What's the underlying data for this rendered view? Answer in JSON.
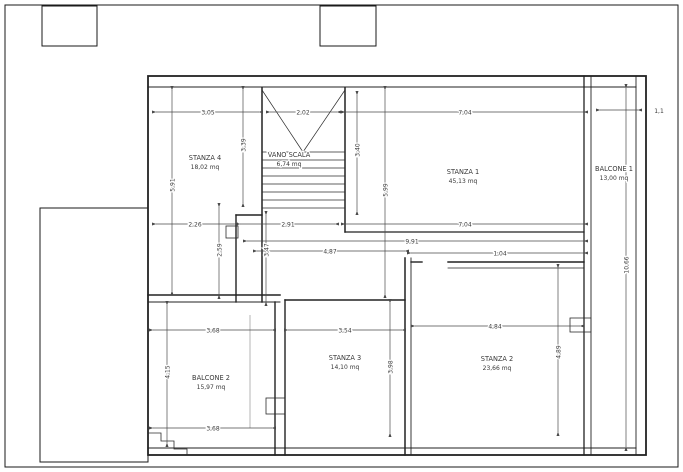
{
  "plan": {
    "rooms": {
      "stanza1": {
        "name": "STANZA 1",
        "area": "45,13 mq"
      },
      "stanza2": {
        "name": "STANZA 2",
        "area": "23,66 mq"
      },
      "stanza3": {
        "name": "STANZA 3",
        "area": "14,10 mq"
      },
      "stanza4": {
        "name": "STANZA 4",
        "area": "18,02 mq"
      },
      "vano_scala": {
        "name": "VANO SCALA",
        "area": "6,74 mq"
      },
      "balcone1": {
        "name": "BALCONE 1",
        "area": "13,00 mq"
      },
      "balcone2": {
        "name": "BALCONE 2",
        "area": "15,97 mq"
      }
    },
    "dimensions": {
      "h_top_stanza4": "3,05",
      "h_top_scala": "2,02",
      "h_top_stanza1": "7,04",
      "h_top_balcone1": "1,1",
      "h_mid_left": "2,26",
      "h_mid_corridoio": "2,91",
      "h_mid_stanza1": "7,04",
      "h_mid_long": "9,91",
      "h_mid_hall": "4,87",
      "h_mid_door": "1,04",
      "h_bot_balcone2": "3,68",
      "h_bot_stanza3": "3,54",
      "h_bot_stanza2": "4,84",
      "h_bot_balcone2_lower": "3,68",
      "v_left_stanza4": "5,91",
      "v_stanza4_inner": "3,39",
      "v_scala_right": "3,40",
      "v_stanza1_left": "5,99",
      "v_left_lower": "2,59",
      "v_corridoio": "3,47",
      "v_balcone1": "10,66",
      "v_balcone2": "4,15",
      "v_stanza3": "3,98",
      "v_stanza2": "4,89"
    },
    "colors": {
      "wall": "#222222",
      "dimension": "#4a4a4a",
      "text": "#3a3a3a",
      "background": "#ffffff"
    }
  }
}
